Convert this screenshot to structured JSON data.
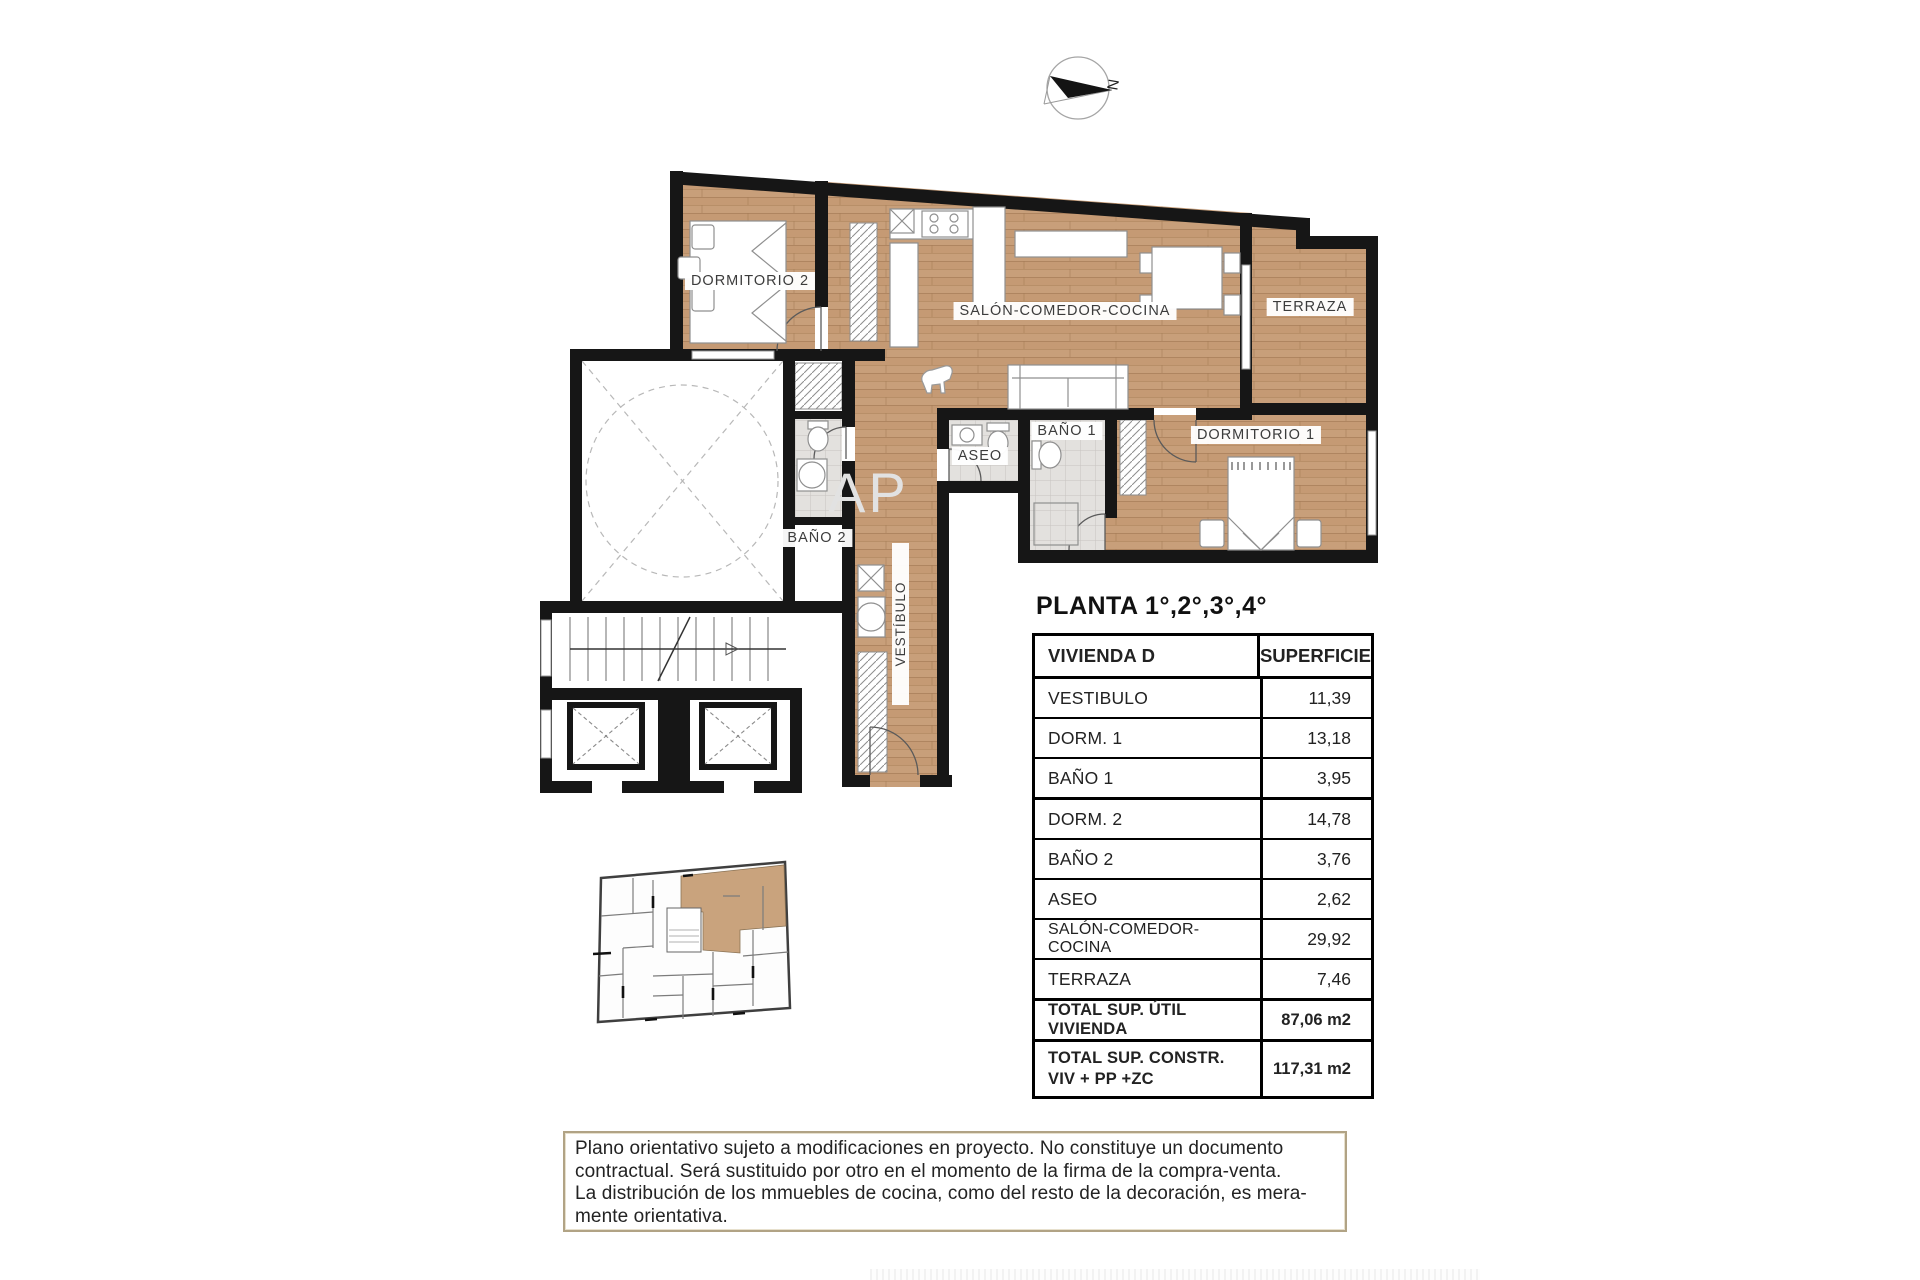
{
  "compass": {
    "north_label": "N"
  },
  "plan_title": "PLANTA 1°,2°,3°,4°",
  "plan": {
    "labels": {
      "dormitorio2": "DORMITORIO 2",
      "salon": "SALÓN-COMEDOR-COCINA",
      "terraza": "TERRAZA",
      "bano1": "BAÑO 1",
      "dormitorio1": "DORMITORIO 1",
      "aseo": "ASEO",
      "bano2": "BAÑO 2",
      "vestibulo": "VESTÍBULO",
      "watermark": "AP"
    }
  },
  "table": {
    "header": {
      "col1": "VIVIENDA D",
      "col2": "SUPERFICIE"
    },
    "rows": [
      {
        "label": "VESTIBULO",
        "value": "11,39"
      },
      {
        "label": "DORM. 1",
        "value": "13,18"
      },
      {
        "label": "BAÑO 1",
        "value": "3,95"
      },
      {
        "label": "DORM. 2",
        "value": "14,78"
      },
      {
        "label": "BAÑO 2",
        "value": "3,76"
      },
      {
        "label": "ASEO",
        "value": "2,62"
      },
      {
        "label": "SALÓN-COMEDOR-COCINA",
        "value": "29,92"
      },
      {
        "label": "TERRAZA",
        "value": "7,46"
      }
    ],
    "totals": [
      {
        "label": "TOTAL SUP. ÚTIL VIVIENDA",
        "value": "87,06 m2"
      },
      {
        "label": "TOTAL SUP. CONSTR.",
        "label2": "VIV + PP +ZC",
        "value": "117,31 m2"
      }
    ]
  },
  "disclaimer": {
    "lines": [
      "Plano orientativo sujeto a modificaciones en proyecto. No constituye un documento",
      "contractual. Será sustituido por otro en el momento de la firma de la compra-venta.",
      "La distribución de los mmuebles de cocina, como del resto de la decoración, es mera-",
      "mente orientativa."
    ]
  },
  "colors": {
    "wood": "#c59a74",
    "wall": "#161616",
    "tile": "#e2e0de",
    "highlight": "#c9a37d",
    "disclaimer_border": "#b1a385"
  }
}
